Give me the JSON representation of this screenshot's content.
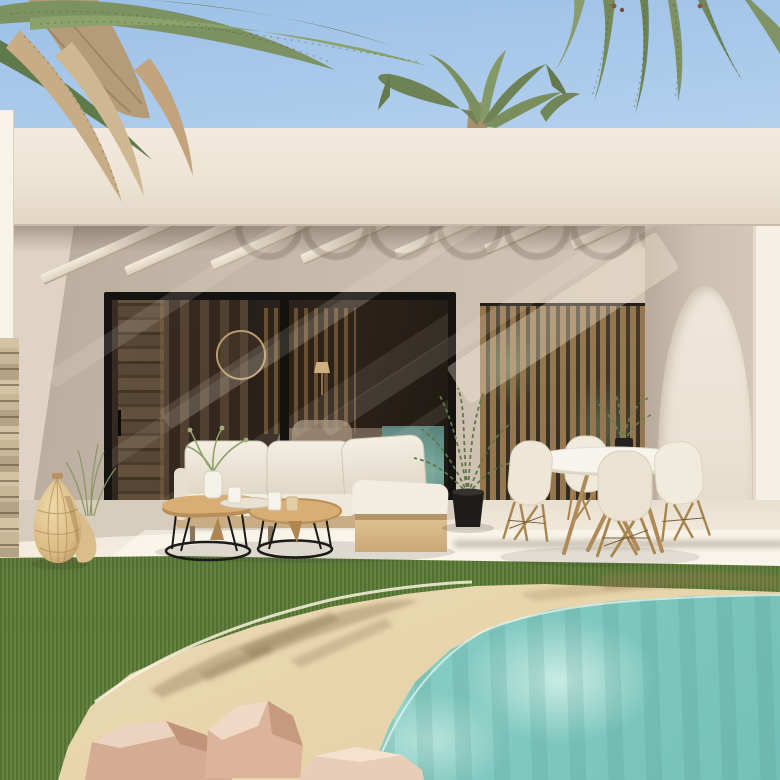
{
  "meta": {
    "type": "architectural-render",
    "description": "3D exterior rendering of a modern white Mediterranean villa: covered terrace with pergola beams, black-framed sliding glass doors, wooden slat privacy screen, arched side wall, outdoor lounge sofa with twin coffee tables, round dining set with four shell chairs, rattan lantern, potted fern, green lawn and a natural sand-edged turquoise pool with rocks, framed by palm trees"
  },
  "palette": {
    "sky_top": "#9cc0e6",
    "sky_mid": "#b7d2ee",
    "sky_bottom": "#cfe0f2",
    "fascia": "#ece3d4",
    "wall_shade": "#c6b9ab",
    "wall_light": "#ded3c4",
    "arch_wall": "#cdc1b2",
    "arch_light": "#eae1d3",
    "pillar_white": "#f5efe6",
    "frame_black": "#151312",
    "glass_dark": "#2b231d",
    "slat_wood": "#96764f",
    "floor_light": "#f7f1e4",
    "floor_shade": "#d6cdbd",
    "grass": "#5d7c3c",
    "grass_dark": "#4a652e",
    "sand": "#ecdcb8",
    "sand_shadow": "#7d6444",
    "water": "#8fd2c8",
    "water_deep": "#74c0b7",
    "cushion": "#efe9dd",
    "cushion_shade": "#d9d0bf",
    "wood_light": "#d8ae74",
    "wood_frame": "#caa172",
    "wire_black": "#1c1a18",
    "chair_shell": "#eee7d8",
    "chair_leg_wood": "#a8854f",
    "rock_light": "#e8cdb8",
    "rock_mid": "#d4ac93",
    "rock_dark": "#bd9077",
    "rattan": "#e2c globalization",
    "rattan_light": "#e8d2a0",
    "rattan_dark": "#b28e5e",
    "palm_green": "#7d9263",
    "palm_green_dark": "#5f7a4a",
    "palm_dry": "#c7ac85",
    "palm_trunk": "#b59c79"
  },
  "scene": {
    "sky": {
      "label": "clear blue sky"
    },
    "palms": {
      "left_cluster": "dense palm canopy with green and dry tan fronds, top-left corner",
      "right_cluster": "green palm fronds hanging from top edge, top-right",
      "crown_behind_roof": "palm crown rising behind the flat roof, center"
    },
    "building": {
      "roof_fascia": "long white flat-roof fascia band",
      "pergola": "white beams fanning under roof with scalloped shadows",
      "glass_doors": "black-framed sliding glass wall reflecting interior, curtains, round mirror and pool",
      "slat_screen": "vertical wooden slat privacy screen",
      "arch": "tall pointed arch opening in sunlit side wall",
      "stone_pillar": "stacked-stone corner pillar, far left"
    },
    "furniture": {
      "sofa": "white outdoor lounge sofa with chaise on light-wood base",
      "coffee_tables": "two nesting coffee tables, oak tops on black wire frames",
      "decor_on_tables": "vase with sprigs, tray, cups and candle",
      "dining_set": "round white table on wooden cross legs with four white shell chairs",
      "lantern": "woven rattan floor lantern",
      "plants": "potted fern, small table plant, ornamental grass tuft"
    },
    "ground": {
      "lawn": "green manicured grass",
      "pool": "turquoise lagoon-style pool with sand-colored beach edge",
      "rocks": "pink-tan boulders at pool edge",
      "shadows": "palm frond shadows cast across the sand"
    }
  }
}
